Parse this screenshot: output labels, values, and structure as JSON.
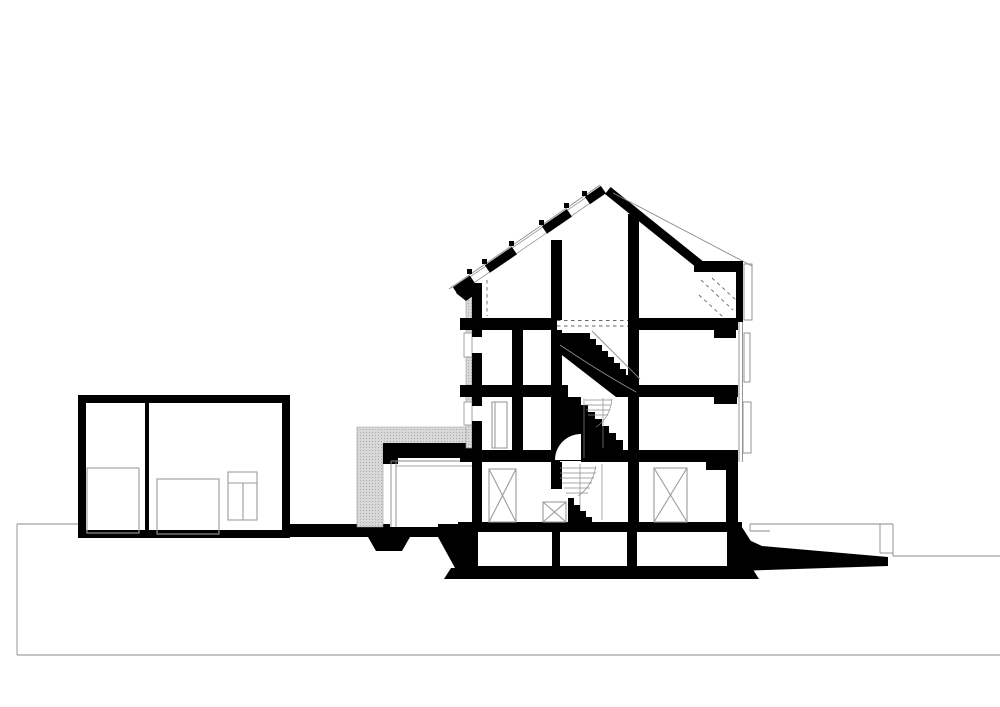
{
  "meta": {
    "title": "Architectural building section drawing",
    "drawing_type": "cross-section",
    "text_labels": []
  },
  "canvas": {
    "width": 1000,
    "height": 707,
    "background": "#ffffff"
  },
  "colors": {
    "paper": "#ffffff",
    "ink": "#000000",
    "thin_line": "#8a8a8a",
    "furniture_line": "#9c9c9c",
    "hatch_fill": "#d8d8d8",
    "hatch_dot": "#ababab"
  },
  "components": {
    "terrain": "ground and terrain lines",
    "outbuilding": "single-storey annex at left with interior fittings",
    "connector": "hatched link structure between annex and main house",
    "main_building": "four-level gabled house cut in section",
    "roof": "pitched roof with three skylight openings and right dormer terrace",
    "stair": "central winder staircase through all storeys",
    "basement": "black poché basement with three rooms",
    "ramp": "sloped access ramp at right"
  }
}
